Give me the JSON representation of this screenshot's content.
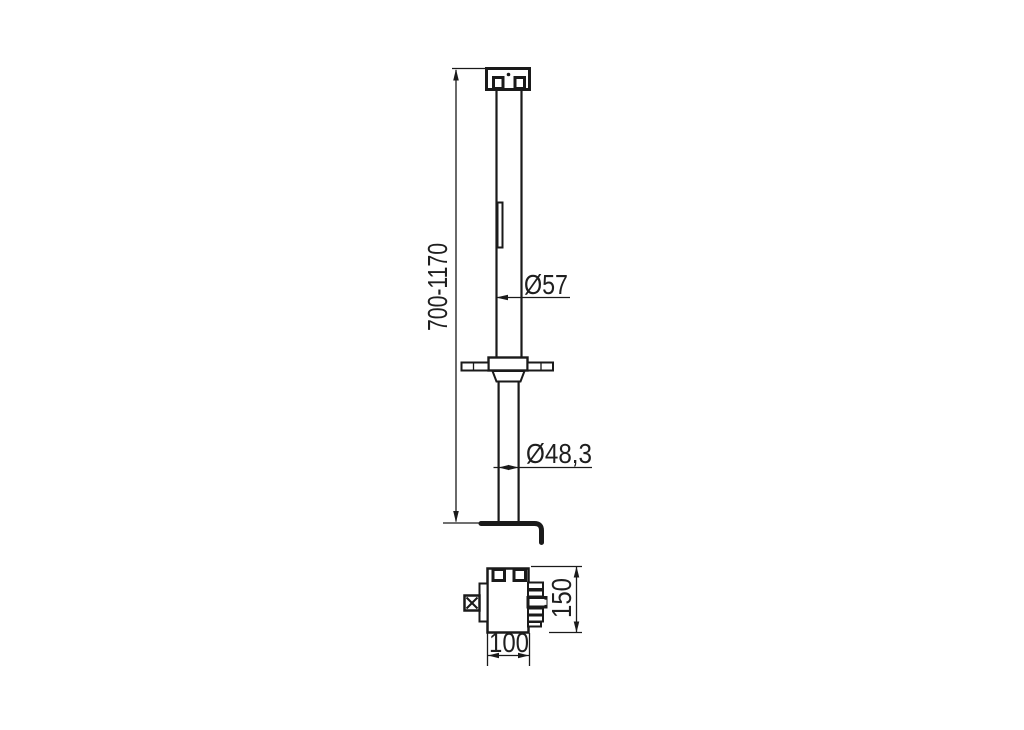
{
  "page": {
    "background": "#ffffff",
    "line_color": "#1a1a1a"
  },
  "drawing": {
    "kind": "technical-drawing-telescopic-support-leg",
    "views": [
      "front-elevation",
      "bottom-plan"
    ],
    "labels": {
      "height_range": "700-1170",
      "upper_diameter": "Ø57",
      "lower_diameter": "Ø48,3",
      "base_depth": "150",
      "base_width": "100"
    }
  }
}
